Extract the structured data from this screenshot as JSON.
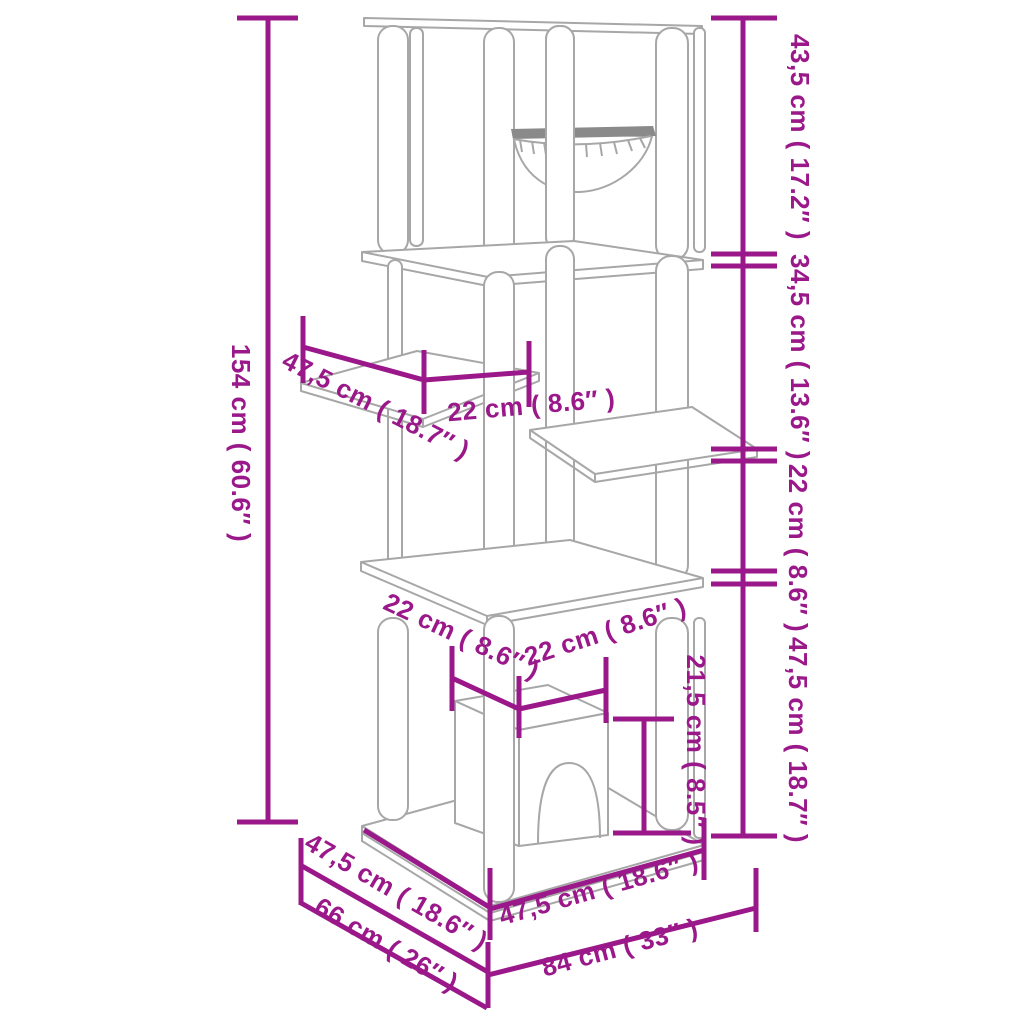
{
  "diagram": {
    "description": "Cat tree with scratching posts and cat house — product dimension line drawing",
    "colors": {
      "dimension": "#9A1889",
      "line_art": "#A7A7A7",
      "background": "#FFFFFF"
    },
    "units": {
      "primary": "cm",
      "secondary": "inches"
    },
    "labels": {
      "total_height": "154 cm ( 60.6″ )",
      "top_section_height": "43,5 cm ( 17.2″ )",
      "upper_mid_section_height": "34,5 cm ( 13.6″ )",
      "lower_mid_section_height": "22 cm ( 8.6″ )",
      "bottom_section_height": "47,5 cm ( 18.7″ )",
      "side_platform_length": "47,5 cm ( 18.7″ )",
      "side_platform_offset": "22 cm ( 8.6″ )",
      "house_depth": "22 cm ( 8.6″ )",
      "house_width": "22 cm ( 8.6″ )",
      "house_height": "21,5 cm ( 8.5″ )",
      "base_depth": "47,5 cm ( 18.6″ )",
      "base_width": "47,5 cm ( 18.6″ )",
      "footprint_depth": "66 cm ( 26″ )",
      "footprint_width": "84 cm ( 33″ )"
    }
  }
}
